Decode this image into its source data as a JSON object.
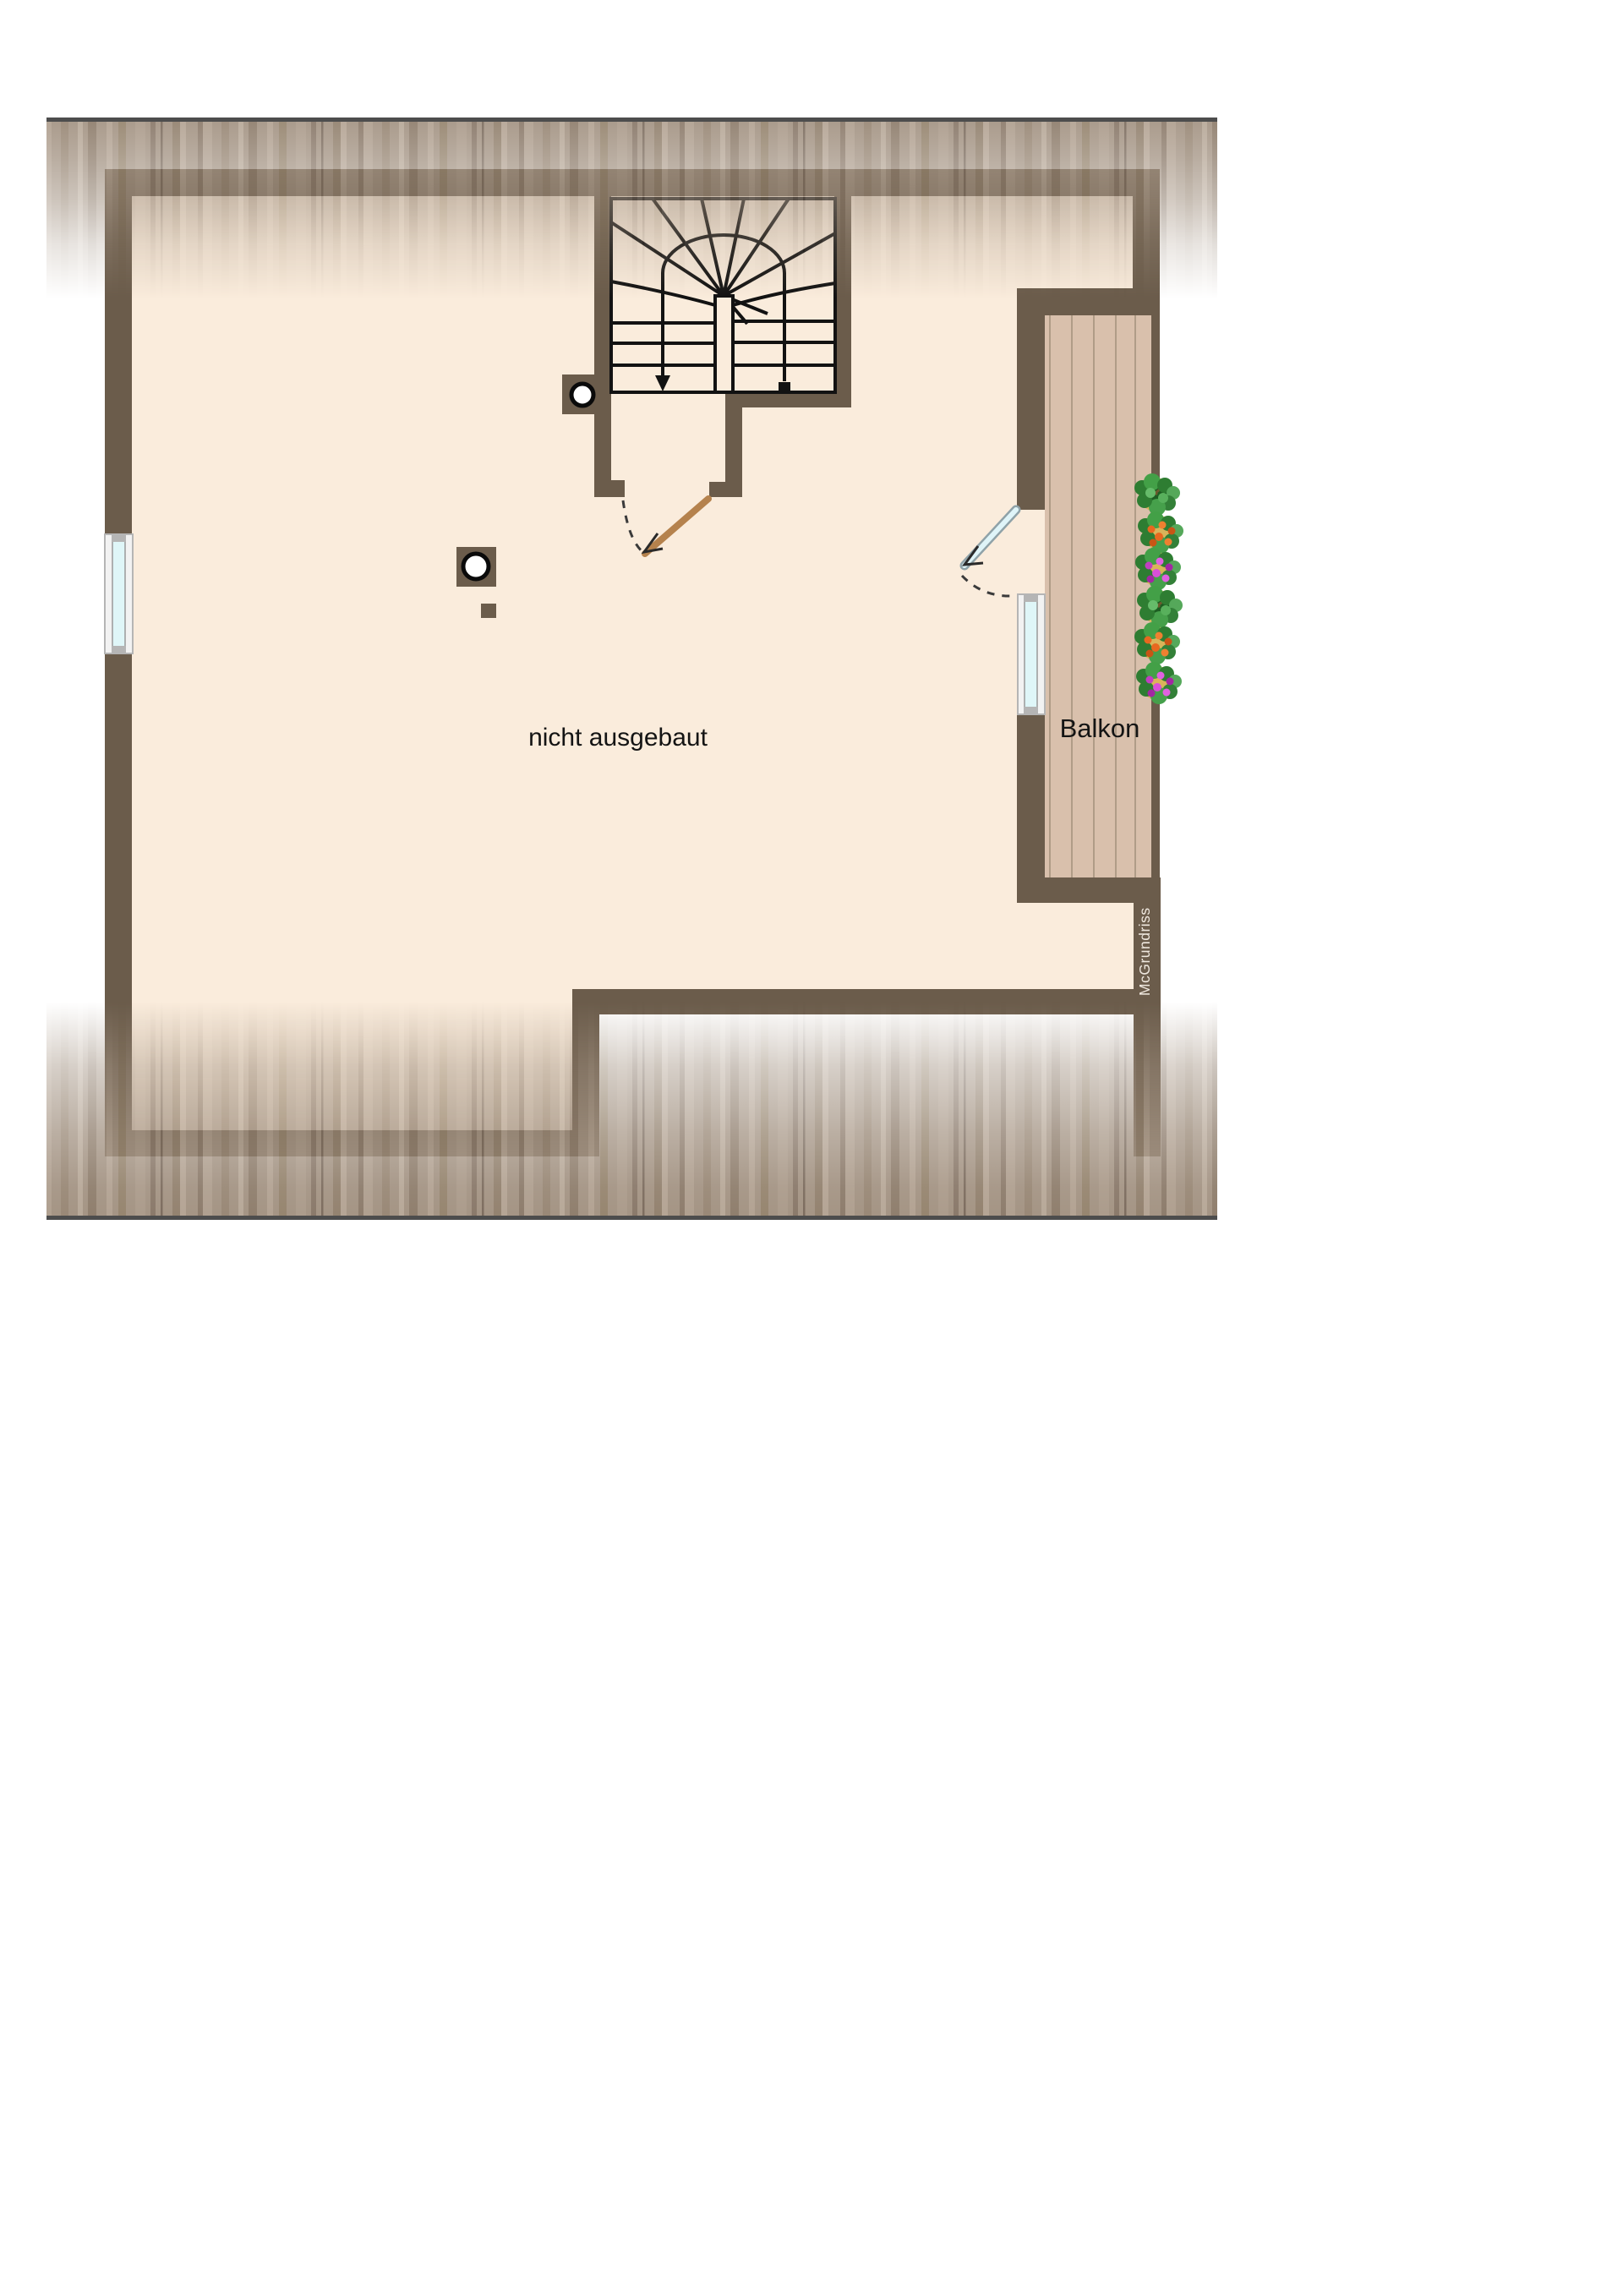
{
  "page": {
    "background_color": "#ffffff"
  },
  "floor_plan": {
    "room_label": "nicht ausgebaut",
    "balcony_label": "Balkon",
    "watermark_label": "McGrundriss",
    "colors": {
      "wall": "#6b5c4b",
      "floor": "#faecdc",
      "balcony_floor": "#d9c0ac",
      "balcony_plank_line": "#a2907b",
      "roof_hatch_base": "#a49484",
      "roof_edge_line": "#4d4d4d",
      "stair_outline": "#121212",
      "door_leaf_wood": "#b5824d",
      "glass": "#dff6f8",
      "window_frame": "#f2f2f2",
      "window_cap": "#b5b5b5",
      "flower_foliage_green": "#3a8a3e",
      "flower_orange": "#e8681f",
      "flower_magenta": "#c13fc1",
      "label_text": "#141414",
      "watermark_text": "#efe8df"
    }
  }
}
